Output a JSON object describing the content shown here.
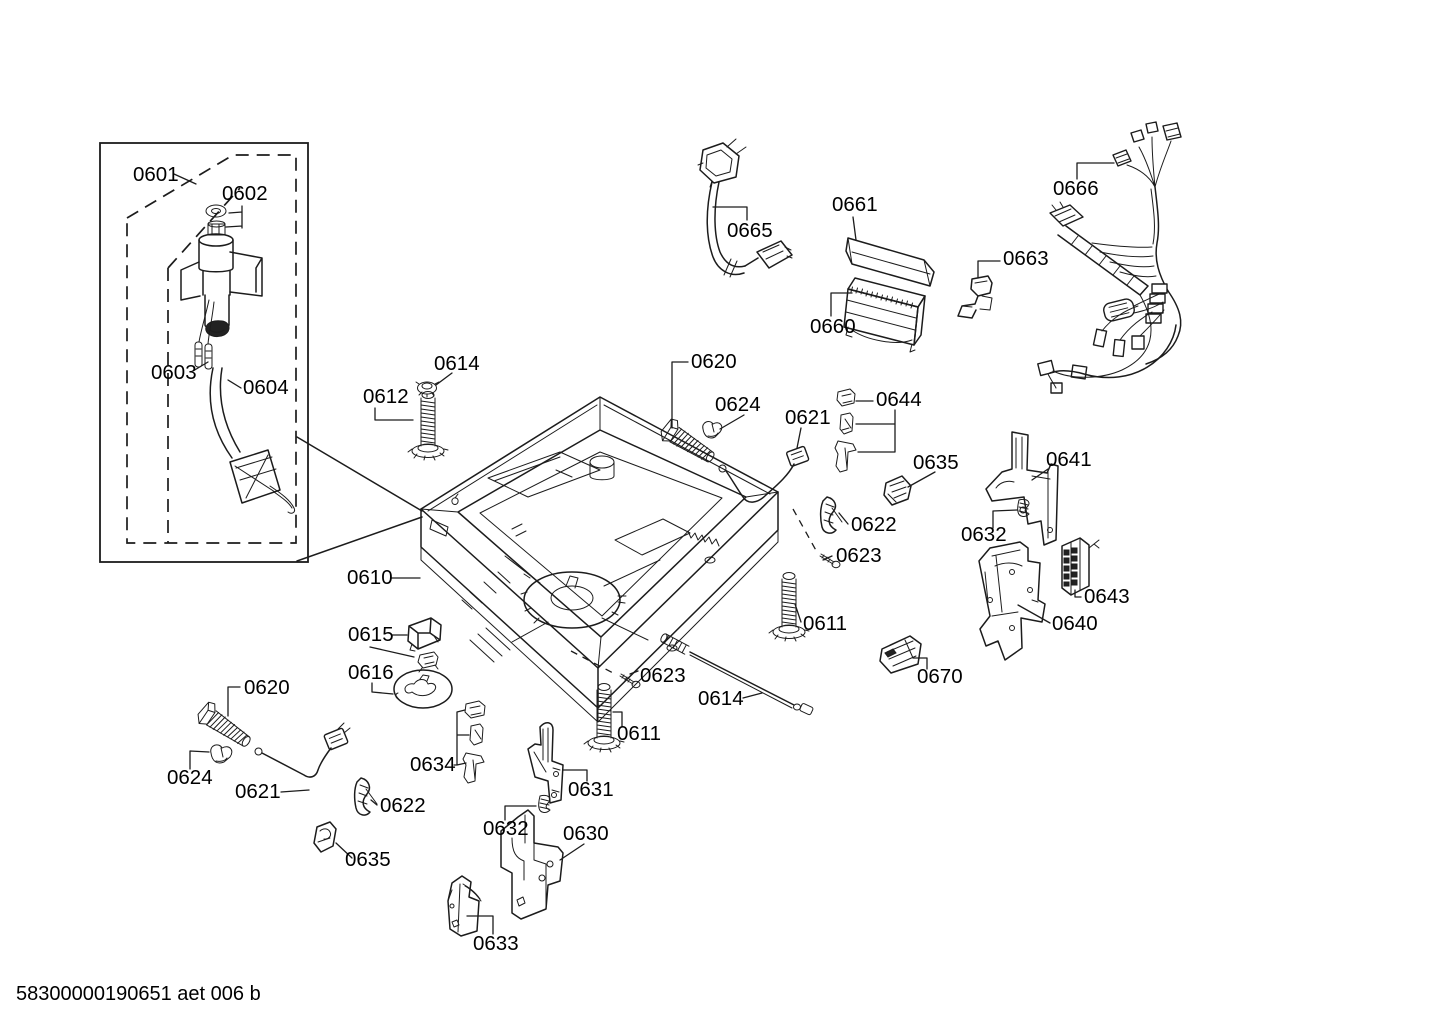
{
  "colors": {
    "line": "#1c1c1c",
    "background": "#ffffff"
  },
  "footer": {
    "doc_number": "58300000190651 aet 006 b"
  },
  "callouts": [
    {
      "part": "0601"
    },
    {
      "part": "0602"
    },
    {
      "part": "0603"
    },
    {
      "part": "0604"
    },
    {
      "part": "0665"
    },
    {
      "part": "0661"
    },
    {
      "part": "0660"
    },
    {
      "part": "0663"
    },
    {
      "part": "0666"
    },
    {
      "part": "0614"
    },
    {
      "part": "0612"
    },
    {
      "part": "0620"
    },
    {
      "part": "0624"
    },
    {
      "part": "0621"
    },
    {
      "part": "0644"
    },
    {
      "part": "0635"
    },
    {
      "part": "0641"
    },
    {
      "part": "0622"
    },
    {
      "part": "0632"
    },
    {
      "part": "0623"
    },
    {
      "part": "0610"
    },
    {
      "part": "0611"
    },
    {
      "part": "0643"
    },
    {
      "part": "0640"
    },
    {
      "part": "0615"
    },
    {
      "part": "0616"
    },
    {
      "part": "0670"
    },
    {
      "part": "0623"
    },
    {
      "part": "0614"
    },
    {
      "part": "0611"
    },
    {
      "part": "0620"
    },
    {
      "part": "0624"
    },
    {
      "part": "0621"
    },
    {
      "part": "0622"
    },
    {
      "part": "0634"
    },
    {
      "part": "0635"
    },
    {
      "part": "0631"
    },
    {
      "part": "0632"
    },
    {
      "part": "0630"
    },
    {
      "part": "0633"
    }
  ]
}
